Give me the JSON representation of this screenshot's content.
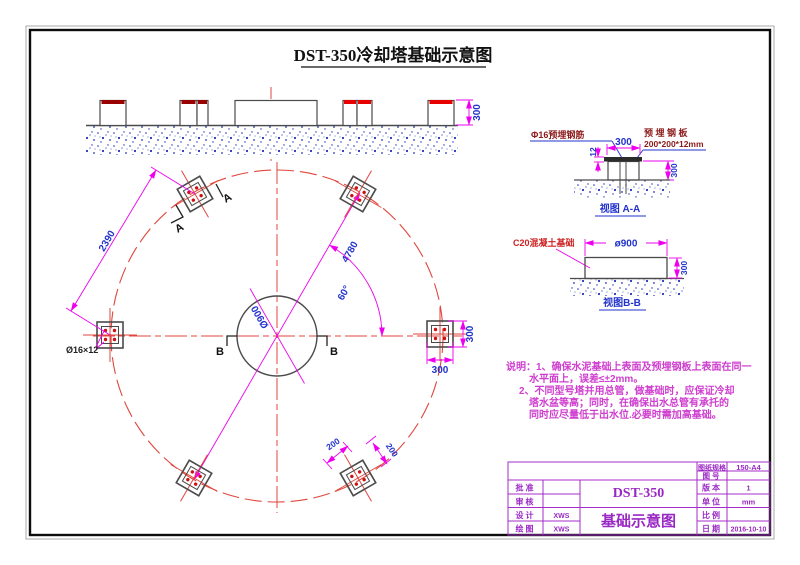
{
  "title": "DST-350冷却塔基础示意图",
  "cross_section": {
    "dim_height": "300"
  },
  "plan": {
    "dim_chord": "2390",
    "dim_diameter": "4780",
    "dim_angle": "60°",
    "dim_center_circle": "Ø900",
    "anchor_label": "Ø16×12",
    "dim_anchor_v": "300",
    "dim_anchor_h": "300",
    "dim_plate_a": "200",
    "dim_plate_b": "200",
    "section_a1": "A",
    "section_a2": "A",
    "section_b1": "B",
    "section_b2": "B"
  },
  "view_aa": {
    "label_rebar": "Φ16预埋钢筋",
    "label_plate_1": "预埋钢板",
    "label_plate_2": "200*200*12mm",
    "dim_top": "300",
    "dim_thickness": "12",
    "dim_depth": "300",
    "caption": "视图 A-A"
  },
  "view_bb": {
    "label_concrete": "C20混凝土基础",
    "dim_width": "ø900",
    "dim_height": "300",
    "caption": "视图B-B"
  },
  "notes": {
    "line1": "说明：1、确保水泥基础上表面及预埋钢板上表面在同一",
    "line2": "水平面上，误差≤±2mm。",
    "line3": "2、不同型号塔并用总管，做基础时，应保证冷却",
    "line4": "塔水盆等高；同时，在确保出水总管有承托的",
    "line5": "同时应尽量低于出水位.必要时需加高基础。"
  },
  "title_block": {
    "spec_label": "图纸规格",
    "spec_value": "150-A4",
    "drawing_no_label": "图号",
    "version_label": "版本",
    "version_value": "1",
    "unit_label": "单位",
    "unit_value": "mm",
    "scale_label": "比例",
    "date_label": "日期",
    "date_value": "2016-10-10",
    "approve_label": "批准",
    "review_label": "审核",
    "design_label": "设计",
    "design_value": "XWS",
    "draft_label": "绘图",
    "draft_value": "XWS",
    "model": "DST-350",
    "doc_title": "基础示意图"
  },
  "colors": {
    "centerline_red": "#e0463c",
    "dimension_magenta": "#ee00ee",
    "dimension_text_blue": "#2233cc",
    "label_maroon": "#8b1a1a",
    "notes_magenta": "#cf3ecf",
    "titleblock_purple": "#9a28c4",
    "outline_gray": "#4a4a4a",
    "stipple_blue": "#2233bb",
    "bolt_red": "#cc1111"
  }
}
